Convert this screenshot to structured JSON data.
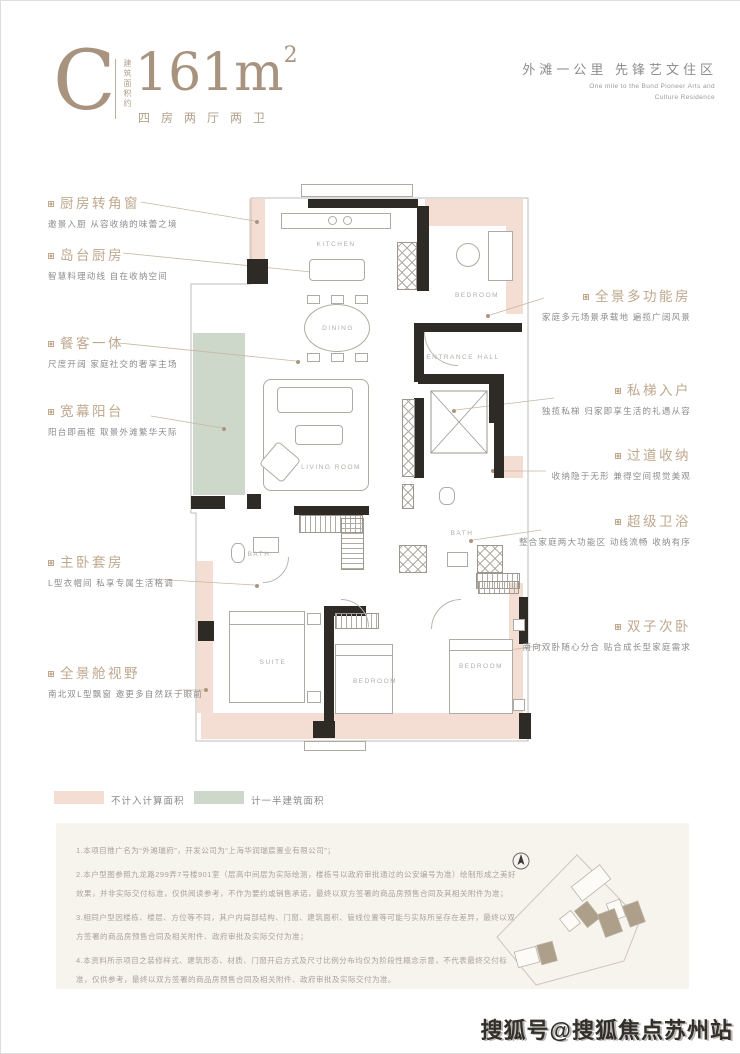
{
  "header": {
    "unit": "C",
    "area_prefix": "建筑面积约",
    "area_value": "161m",
    "area_sup": "2",
    "layout": "四房两厅两卫",
    "slogan_cn": "外滩一公里 先锋艺文住区",
    "slogan_en_1": "One mile to the Bund Pioneer Arts and",
    "slogan_en_2": "Culture Residence"
  },
  "annotations": {
    "left": [
      {
        "title": "厨房转角窗",
        "desc": "邀景入厨 从容收纳的味蕾之境"
      },
      {
        "title": "岛台厨房",
        "desc": "智慧料理动线 自在收纳空间"
      },
      {
        "title": "餐客一体",
        "desc": "尺度开阔 家庭社交的奢享主场"
      },
      {
        "title": "宽幕阳台",
        "desc": "阳台即画框 取景外滩繁华天际"
      },
      {
        "title": "主卧套房",
        "desc": "L型衣帽间 私享专属生活格调"
      },
      {
        "title": "全景舱视野",
        "desc": "南北双L型飘窗 邀更多自然跃于眼前"
      }
    ],
    "right": [
      {
        "title": "全景多功能房",
        "desc": "家庭多元场景承载地 遍揽广阔风景"
      },
      {
        "title": "私梯入户",
        "desc": "独揽私梯 归家即享生活的礼遇从容"
      },
      {
        "title": "过道收纳",
        "desc": "收纳隐于无形 兼得空间视觉美观"
      },
      {
        "title": "超级卫浴",
        "desc": "整合家庭两大功能区 动线流畅 收纳有序"
      },
      {
        "title": "双子次卧",
        "desc": "南向双卧随心分合 贴合成长型家庭需求"
      }
    ]
  },
  "plan": {
    "rooms": [
      {
        "label": "KITCHEN"
      },
      {
        "label": "DINING"
      },
      {
        "label": "BEDROOM"
      },
      {
        "label": "ENTRANCE HALL"
      },
      {
        "label": "LIVING ROOM"
      },
      {
        "label": "BATH"
      },
      {
        "label": "BATH"
      },
      {
        "label": "SUITE"
      },
      {
        "label": "BEDROOM"
      },
      {
        "label": "BEDROOM"
      }
    ]
  },
  "legend": [
    {
      "label": "不计入计算面积",
      "color": "#f4ddd2"
    },
    {
      "label": "计一半建筑面积",
      "color": "#cdd8cb"
    }
  ],
  "notes": [
    "1.本项目推广名为“外滩瑞府”，开发公司为“上海华润瑞宸置业有限公司”；",
    "2.本户型图参照九龙路299弄7号楼901室（层高中间层为实际绘测，楼栋号以政府审批通过的公安编号为准）绘制形成之美好效果，并非实际交付标准，仅供阅读参考，不作为要约或销售承诺，最终以双方签署的商品房预售合同及其相关附件为准；",
    "3.相同户型因楼栋、楼层、方位等不同，其户内局部结构、门窗、建筑面积、管线位置等可能与实际所呈存在差异，最终以双方签署的商品房预售合同及相关附件、政府审批及实际交付为准；",
    "4.本资料所示项目之装修样式、建筑形态、材质、门窗开启方式及尺寸比例分布均仅为阶段性概念示意，不代表最终交付标准，仅供参考，最终以双方签署的商品房预售合同及相关附件、政府审批及实际交付为准。"
  ],
  "watermark": "搜狐号@搜狐焦点苏州站",
  "colors": {
    "accent": "#a8937f",
    "annotation_title": "#bfa88e",
    "pink_area": "#f4ddd2",
    "green_area": "#cdd8cb",
    "wall": "#2e2a26"
  }
}
